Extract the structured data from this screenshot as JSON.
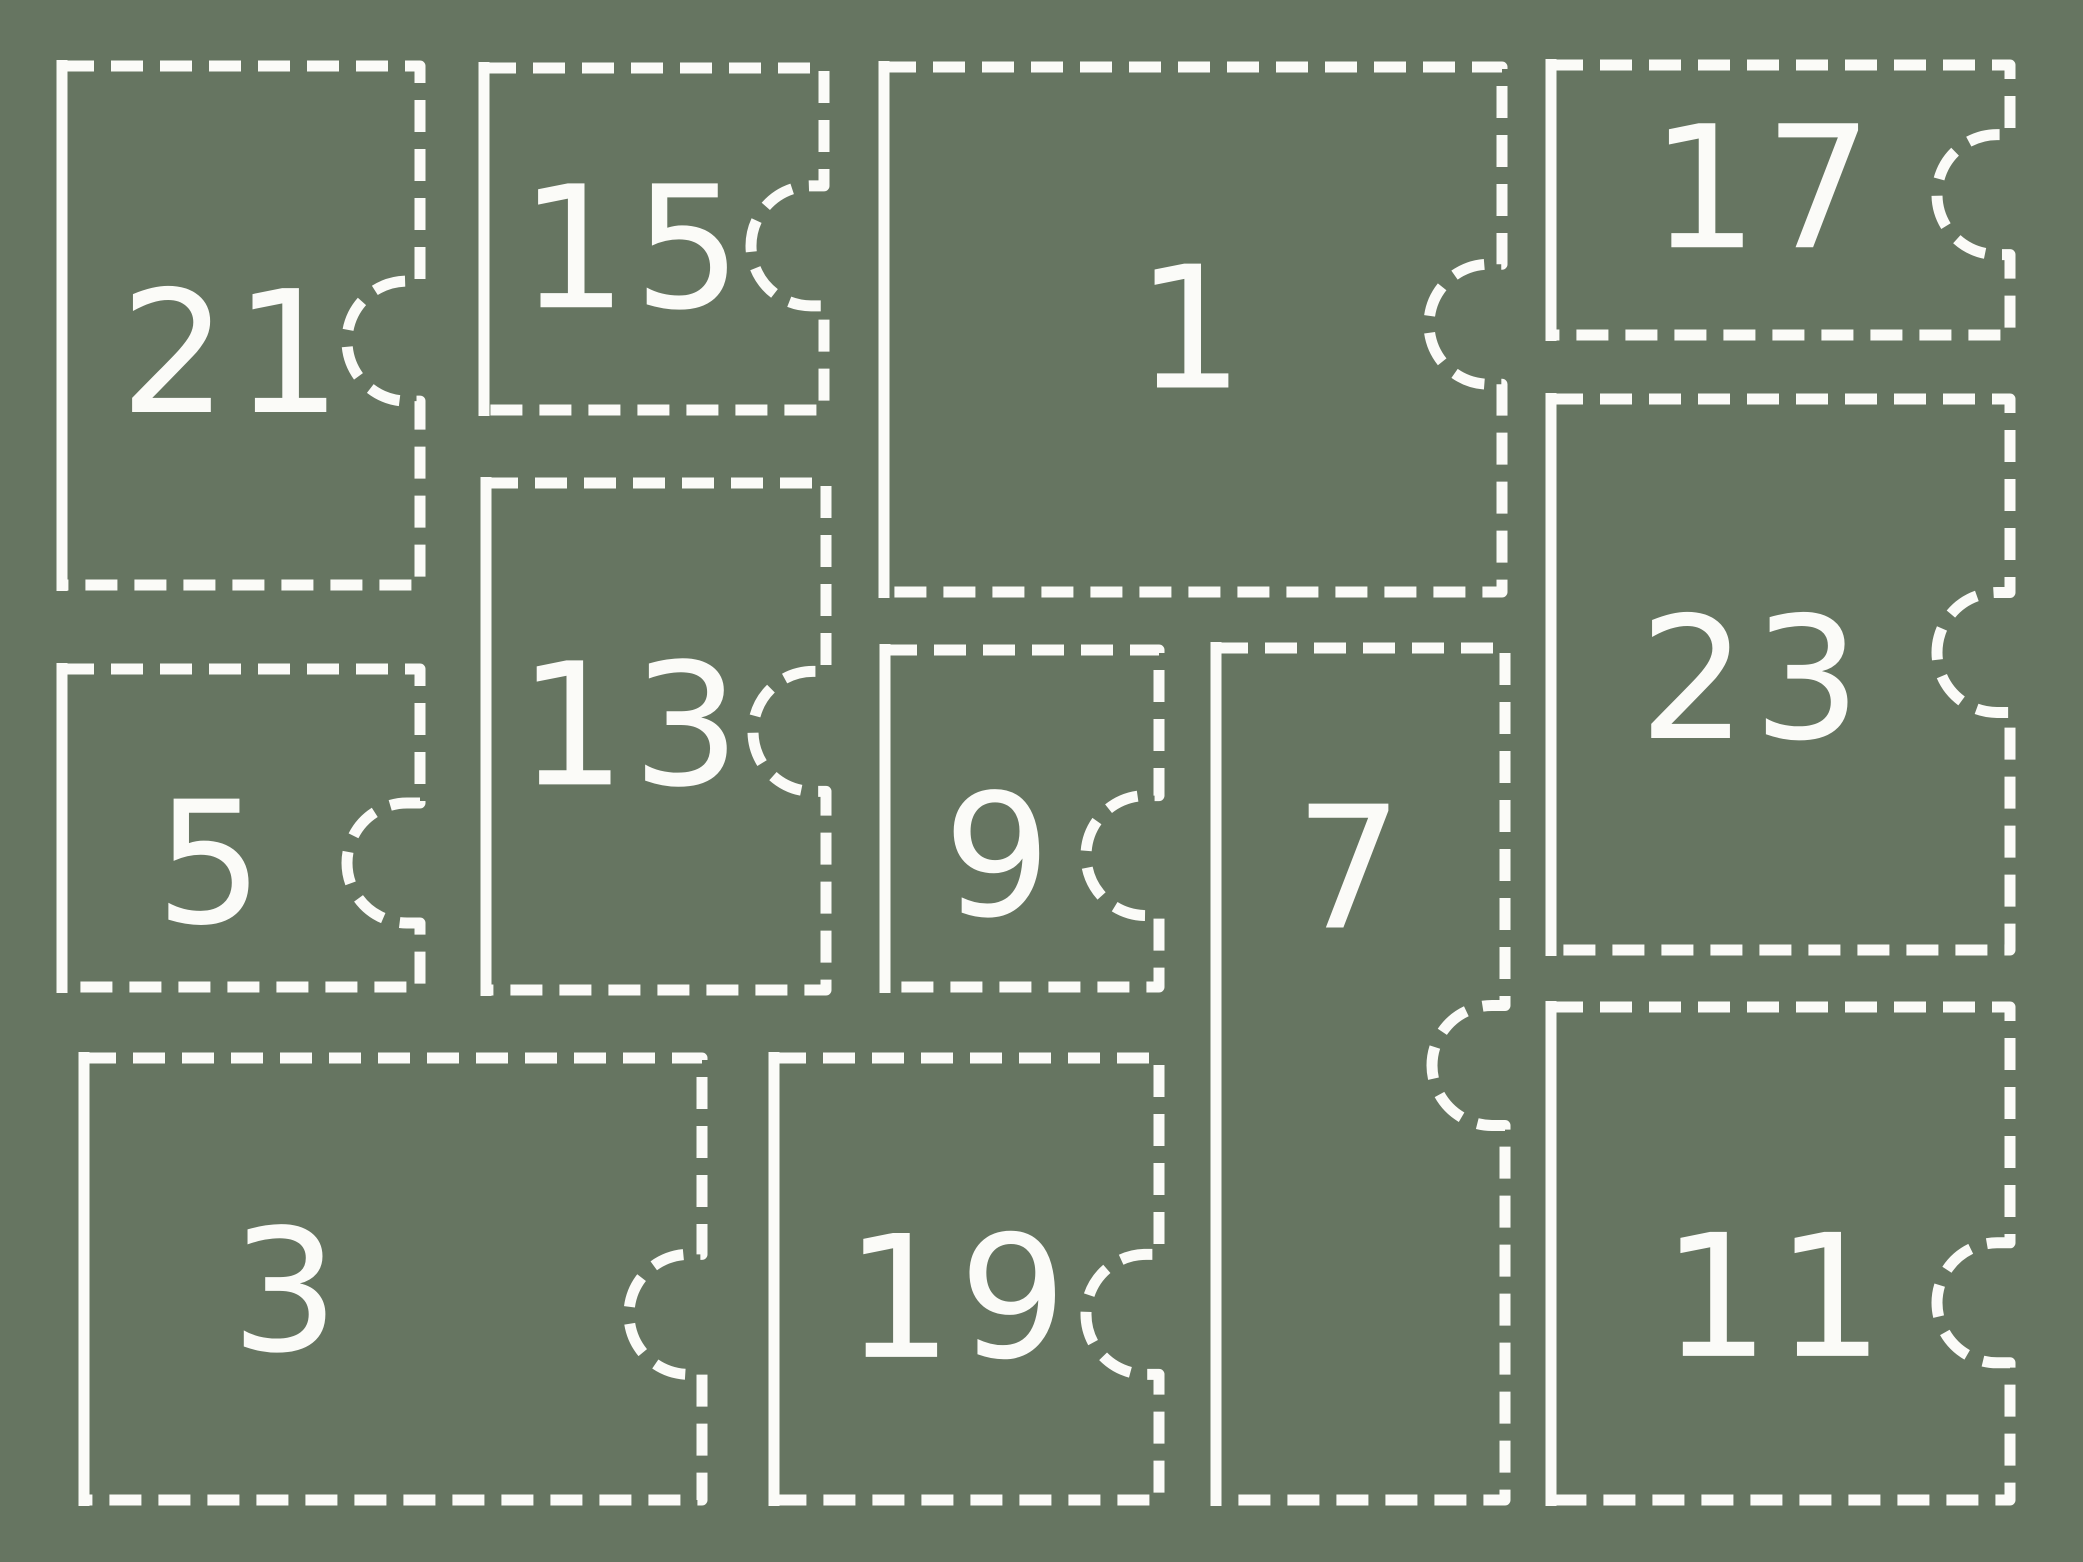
{
  "canvas": {
    "width": 2083,
    "height": 1562,
    "background_color": "#667561",
    "stroke_color": "#fbfbf8"
  },
  "style": {
    "dash_length": 32,
    "dash_gap": 17,
    "stroke_width": 11,
    "notch_radius": 60,
    "notch_stub": 13,
    "font_size": 170,
    "left_edge_overshoot": 6
  },
  "calendar": {
    "description": "advent-calendar ticket grid",
    "boxes": [
      {
        "number": "21",
        "x": 62,
        "y": 66,
        "w": 358,
        "h": 519,
        "notch_y_frac": 0.53,
        "label_x_frac": 0.48,
        "label_y_frac": 0.555
      },
      {
        "number": "15",
        "x": 484,
        "y": 68,
        "w": 340,
        "h": 342,
        "notch_y_frac": 0.52,
        "label_x_frac": 0.44,
        "label_y_frac": 0.53
      },
      {
        "number": "1",
        "x": 884,
        "y": 67,
        "w": 618,
        "h": 525,
        "notch_y_frac": 0.49,
        "label_x_frac": 0.5,
        "label_y_frac": 0.5
      },
      {
        "number": "17",
        "x": 1551,
        "y": 65,
        "w": 459,
        "h": 270,
        "notch_y_frac": 0.48,
        "label_x_frac": 0.465,
        "label_y_frac": 0.46
      },
      {
        "number": "5",
        "x": 62,
        "y": 669,
        "w": 358,
        "h": 318,
        "notch_y_frac": 0.61,
        "label_x_frac": 0.42,
        "label_y_frac": 0.615
      },
      {
        "number": "13",
        "x": 486,
        "y": 483,
        "w": 340,
        "h": 507,
        "notch_y_frac": 0.49,
        "label_x_frac": 0.43,
        "label_y_frac": 0.48
      },
      {
        "number": "9",
        "x": 885,
        "y": 650,
        "w": 274,
        "h": 337,
        "notch_y_frac": 0.61,
        "label_x_frac": 0.42,
        "label_y_frac": 0.615
      },
      {
        "number": "7",
        "x": 1216,
        "y": 648,
        "w": 289,
        "h": 852,
        "notch_y_frac": 0.49,
        "label_x_frac": 0.47,
        "label_y_frac": 0.26
      },
      {
        "number": "23",
        "x": 1551,
        "y": 399,
        "w": 459,
        "h": 551,
        "notch_y_frac": 0.46,
        "label_x_frac": 0.44,
        "label_y_frac": 0.51
      },
      {
        "number": "3",
        "x": 84,
        "y": 1058,
        "w": 618,
        "h": 442,
        "notch_y_frac": 0.58,
        "label_x_frac": 0.33,
        "label_y_frac": 0.53
      },
      {
        "number": "19",
        "x": 774,
        "y": 1058,
        "w": 385,
        "h": 442,
        "notch_y_frac": 0.58,
        "label_x_frac": 0.48,
        "label_y_frac": 0.545
      },
      {
        "number": "11",
        "x": 1551,
        "y": 1007,
        "w": 459,
        "h": 493,
        "notch_y_frac": 0.6,
        "label_x_frac": 0.49,
        "label_y_frac": 0.59
      }
    ]
  }
}
